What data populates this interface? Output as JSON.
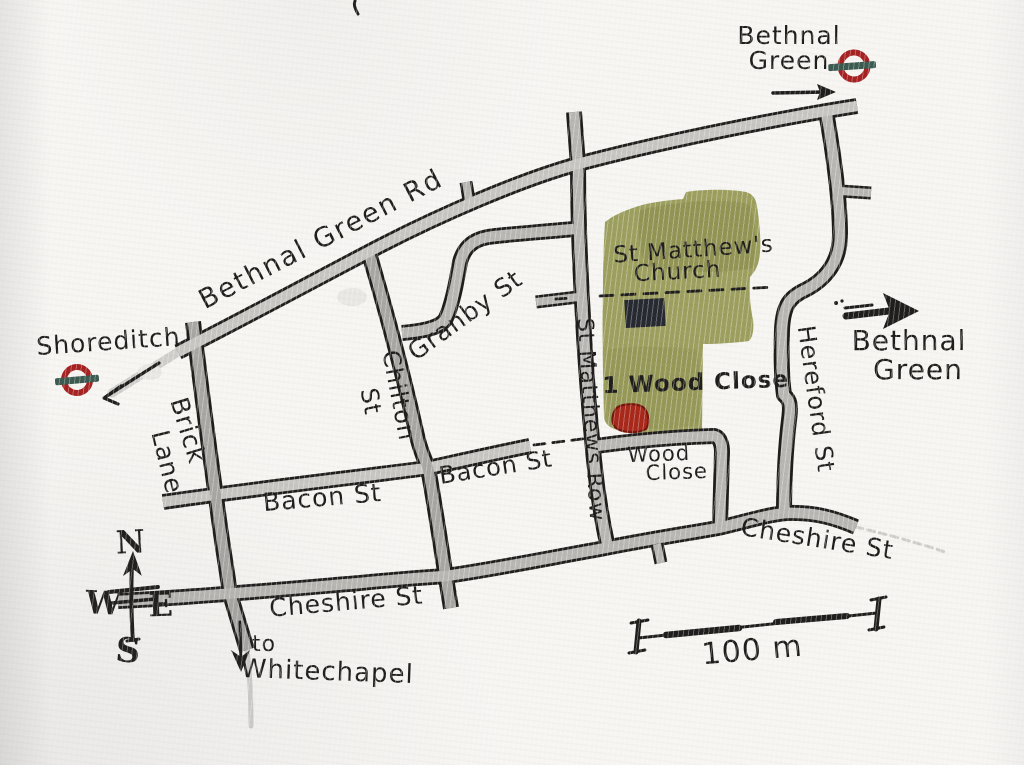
{
  "map_title": "Hand-drawn watercolour street map of the Bethnal Green area",
  "labels": {
    "bethnal_green_rd": "Bethnal Green Rd",
    "brick_line1": "Brick",
    "brick_line2": "Lane",
    "chilton_line1": "Chilton",
    "chilton_line2": "St",
    "granby": "Granby St",
    "bacon": "Bacon St",
    "cheshire": "Cheshire St",
    "st_matthews_row": "St Matthews Row",
    "wood_close_line1": "Wood",
    "wood_close_line2": "Close",
    "hereford": "Hereford St",
    "church_line1": "St Matthew's",
    "church_line2": "Church",
    "address": "1 Wood Close",
    "shoreditch": "Shoreditch",
    "bethnal_green_line1": "Bethnal",
    "bethnal_green_line2": "Green",
    "to": "to",
    "whitechapel": "Whitechapel"
  },
  "compass": {
    "n": "N",
    "w": "W",
    "e": "E",
    "s": "S"
  },
  "scale": {
    "label": "100 m"
  },
  "colors": {
    "ink": "#1f1e1c",
    "paper": "#f6f5f2",
    "road_light": "#c7c6c2",
    "road_mid": "#b8b7b3",
    "road_dark": "#a8a7a3",
    "church_green": "#94964f",
    "marker_red": "#a8281a",
    "roundel_red": "#a62222",
    "roundel_bar": "#3c5a50",
    "pencil": "#cfcecb"
  }
}
